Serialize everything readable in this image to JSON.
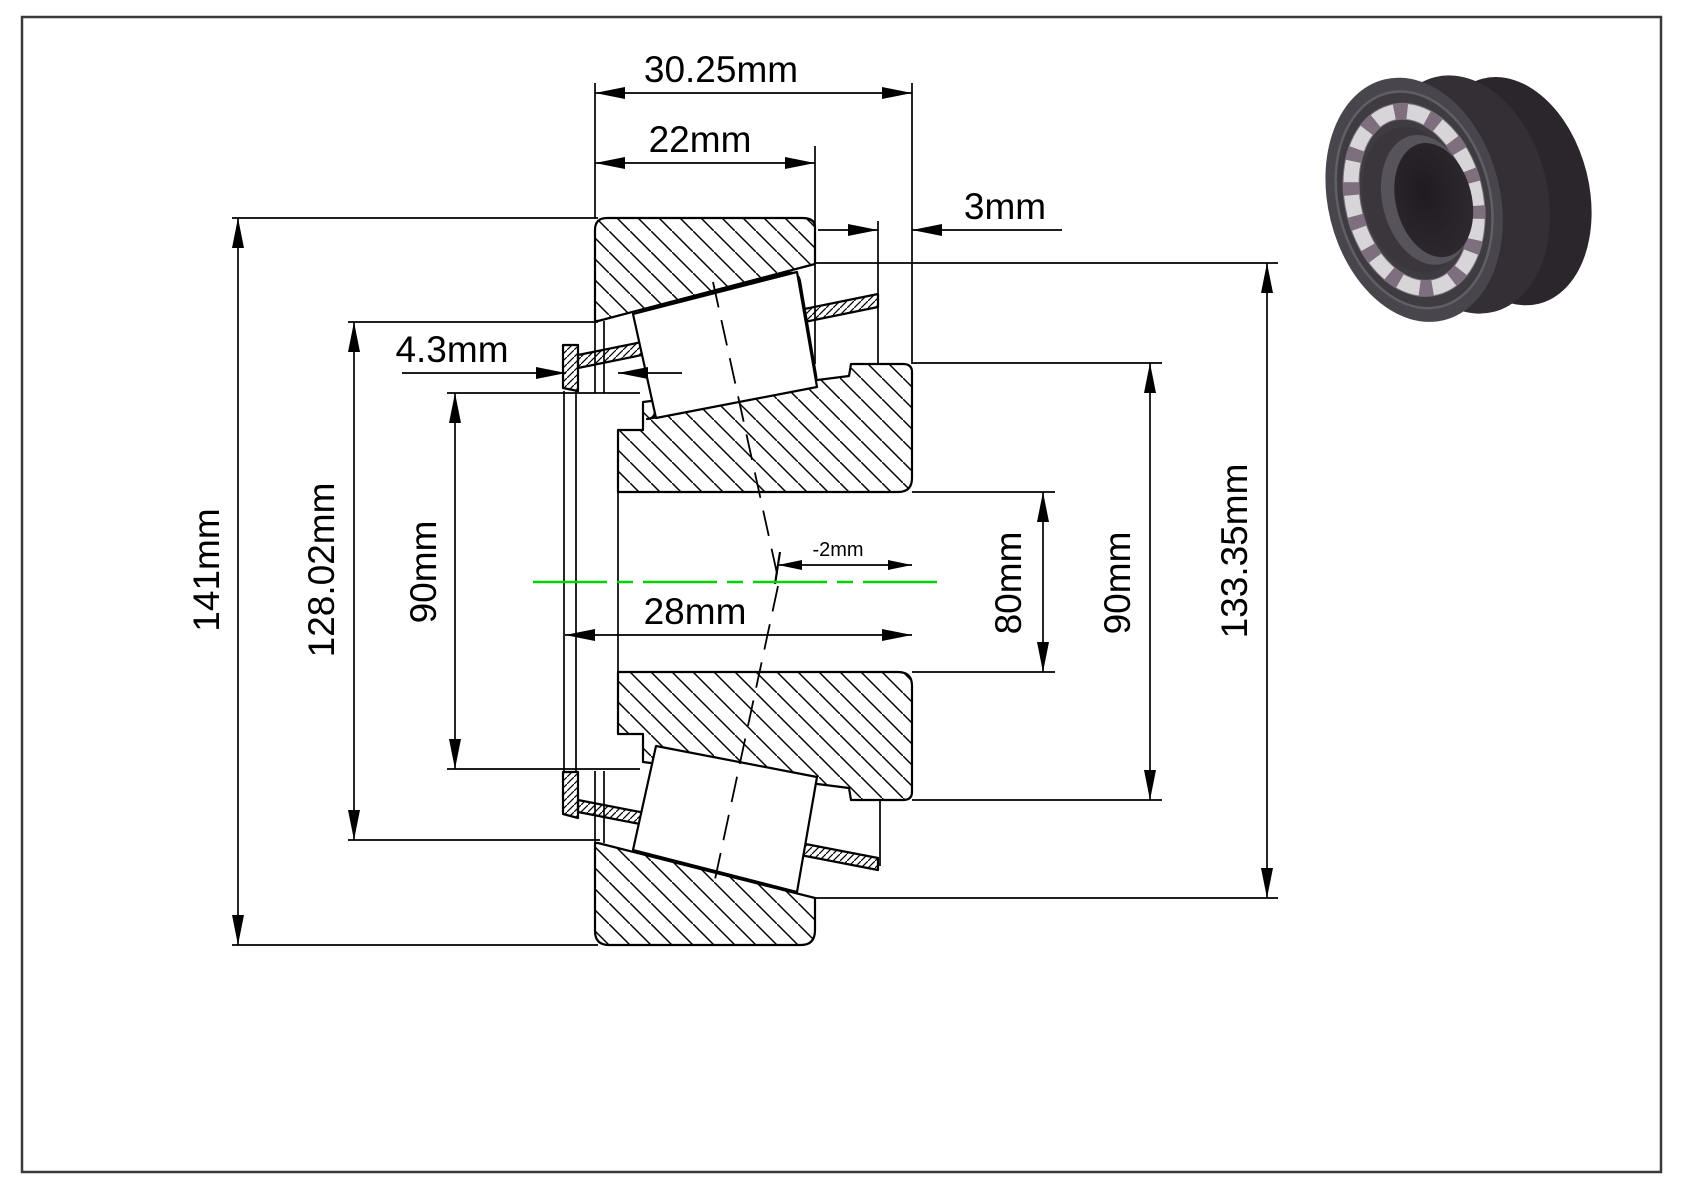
{
  "drawing": {
    "type": "tapered-roller-bearing-cross-section",
    "colors": {
      "line": "#000000",
      "centerline": "#00d400",
      "background": "#ffffff",
      "border": "#3a3a3a"
    },
    "dimensions": {
      "total_width": "30.25mm",
      "cup_width": "22mm",
      "back_protrusion": "3mm",
      "front_protrusion": "4.3mm",
      "cone_width": "28mm",
      "effective_center": "-2mm",
      "flange_od": "141mm",
      "flange_back_od": "128.02mm",
      "front_rib_od": "90mm",
      "bore_diameter": "80mm",
      "back_rib_od": "90mm",
      "cup_od": "133.35mm"
    }
  }
}
